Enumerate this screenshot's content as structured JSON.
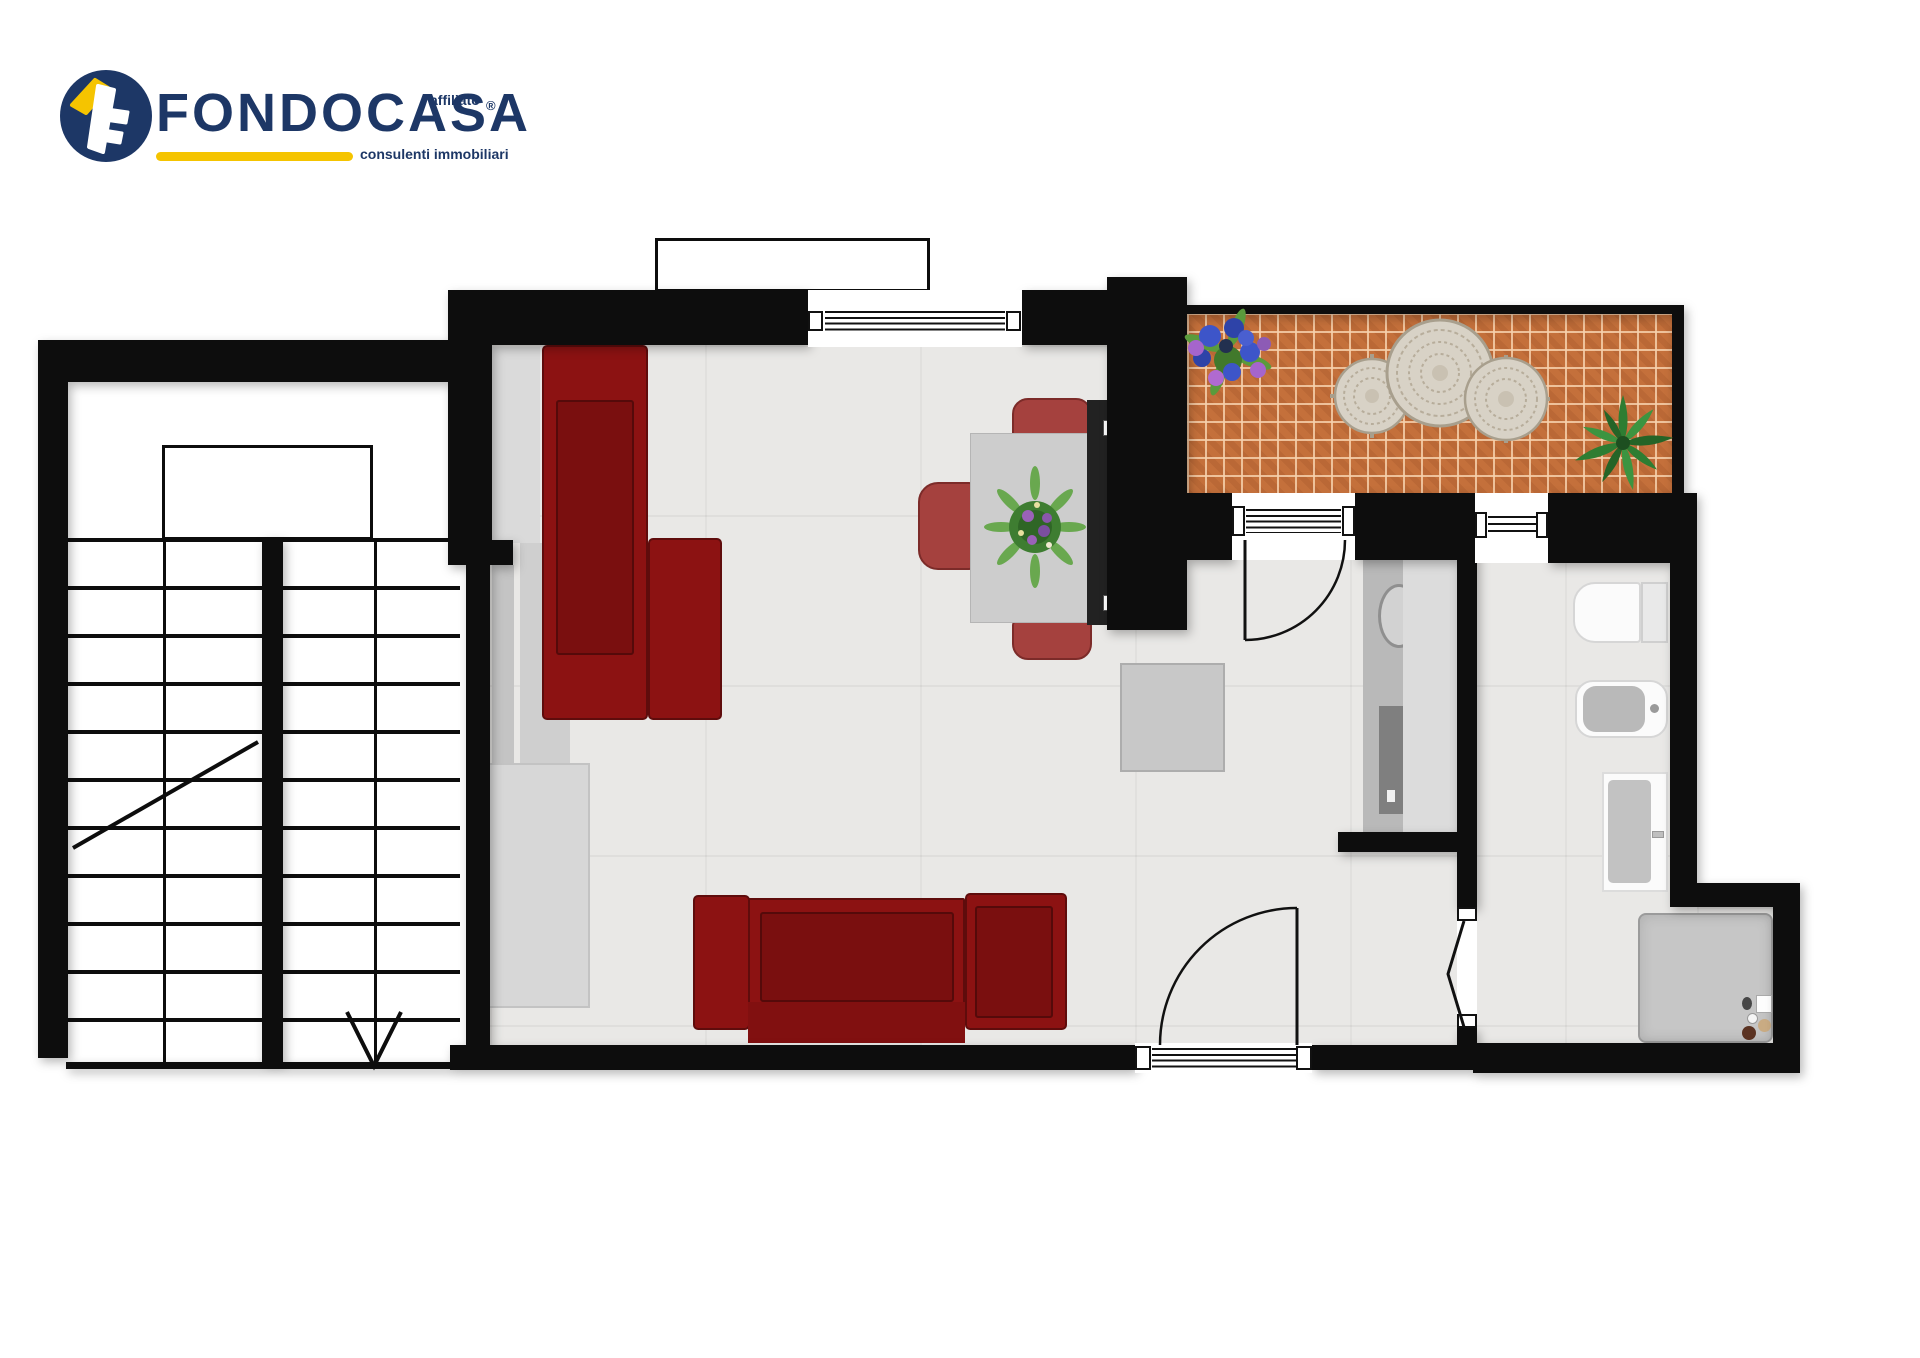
{
  "logo": {
    "brand": "FONDOCASA",
    "affiliate_label": "affiliato",
    "registered_mark": "®",
    "tagline": "consulenti immobiliari",
    "colors": {
      "brand_navy": "#1d3766",
      "accent_yellow": "#f5c400"
    }
  },
  "floorplan": {
    "colors": {
      "wall": "#0d0d0d",
      "floor_tile": "#e9e8e6",
      "terrace_brick": "#c4703b",
      "sofa_red": "#8c1212",
      "chair_red": "#a5413e",
      "counter_gray": "#b9b9b9",
      "shower_gray": "#c6c6c6"
    },
    "rooms": [
      "staircase",
      "living-dining-room",
      "terrace",
      "kitchen-nook",
      "bathroom"
    ],
    "furniture": {
      "living_room": [
        "long-red-sofa",
        "red-sofa",
        "sideboard",
        "storage-cabinet",
        "dining-table",
        "dining-chairs",
        "table-plant",
        "media-unit",
        "hall-cabinet"
      ],
      "terrace": [
        "wrought-iron-table-set",
        "flower-pot",
        "agave-plant"
      ],
      "kitchen": [
        "counter-with-round-sink",
        "cooktop"
      ],
      "bathroom": [
        "toilet",
        "bidet",
        "washbasin",
        "shower-tray"
      ]
    },
    "doors": [
      "terrace-french-door",
      "south-french-door",
      "bathroom-folding-door"
    ],
    "windows": [
      "living-room-window",
      "bathroom-window"
    ],
    "stair": {
      "flights": 2,
      "direction_symbol": "diagonal-line-and-v-arrow"
    }
  }
}
